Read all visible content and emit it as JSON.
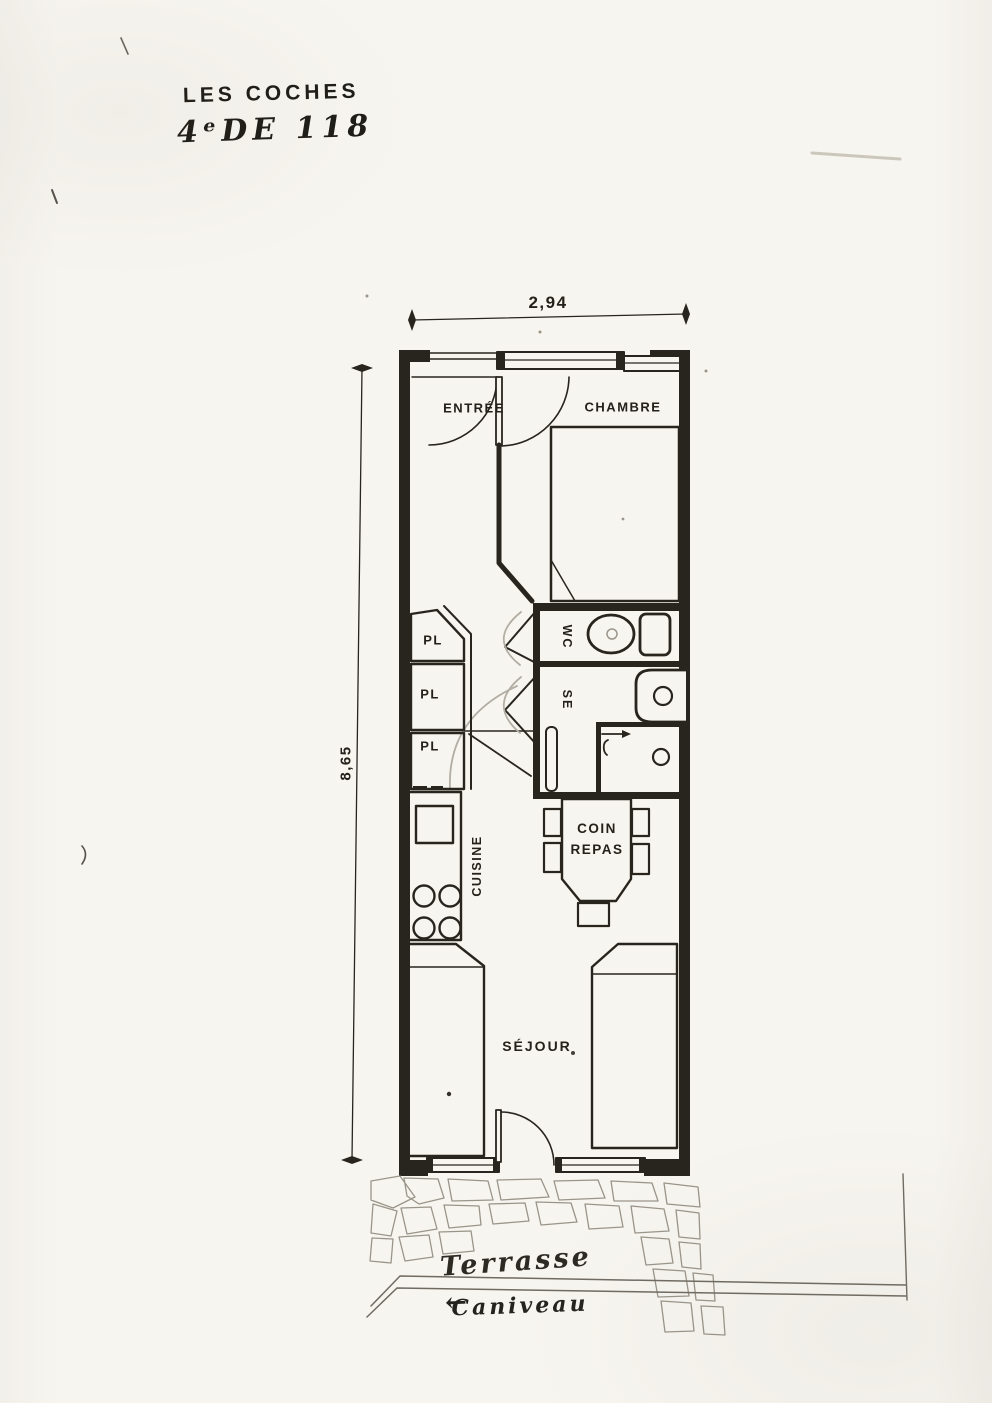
{
  "header": {
    "line1": "LES COCHES",
    "line2": "4ᵉDE 118"
  },
  "dimensions": {
    "width": "2,94",
    "height": "8,65"
  },
  "rooms": {
    "entree": "ENTRÉE",
    "chambre": "CHAMBRE",
    "wc": "WC",
    "se": "SE",
    "pl": [
      "PL",
      "PL",
      "PL"
    ],
    "cuisine": "CUISINE",
    "coin_repas": [
      "COIN",
      "REPAS"
    ],
    "sejour": "SÉJOUR"
  },
  "exterior": {
    "terrasse": "Terrasse",
    "caniveau_arrow": "←",
    "caniveau": "Caniveau"
  },
  "colors": {
    "paper": "#f7f5ef",
    "ink": "#28251e",
    "pencil": "#b3aea4"
  }
}
